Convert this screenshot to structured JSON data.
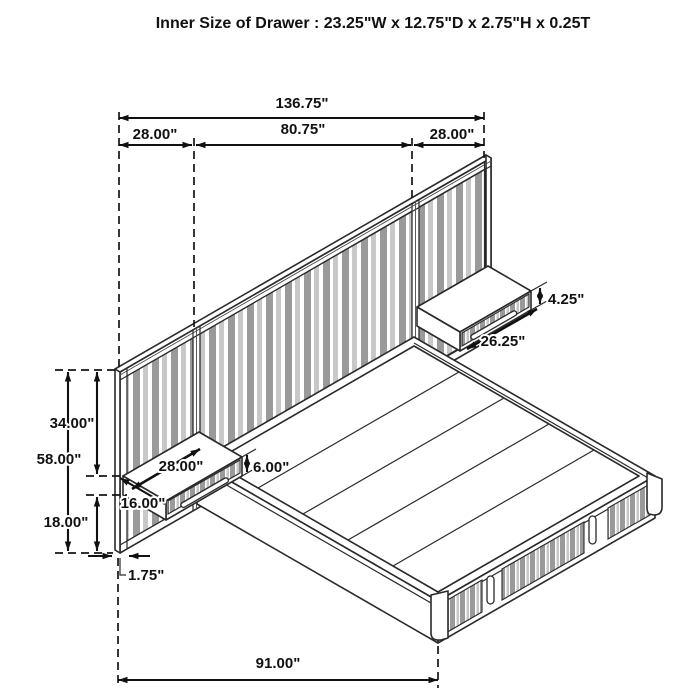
{
  "title": "Inner Size of Drawer : 23.25\"W x 12.75\"D x 2.75\"H x 0.25T",
  "colors": {
    "line": "#1a1a1a",
    "slat_dark": "#9a9a9a",
    "slat_light": "#c8c8c8",
    "background": "#ffffff"
  },
  "dimensions": {
    "total_width": "136.75\"",
    "left_section_width": "28.00\"",
    "center_section_width": "80.75\"",
    "right_section_width": "28.00\"",
    "right_nightstand_height": "4.25\"",
    "right_nightstand_width": "26.25\"",
    "upper_panel_height": "34.00\"",
    "total_panel_height": "58.00\"",
    "left_nightstand_width": "28.00\"",
    "left_nightstand_height": "6.00\"",
    "left_nightstand_depth": "16.00\"",
    "lower_panel_height": "18.00\"",
    "panel_thickness": "1.75\"",
    "bed_length": "91.00\""
  }
}
